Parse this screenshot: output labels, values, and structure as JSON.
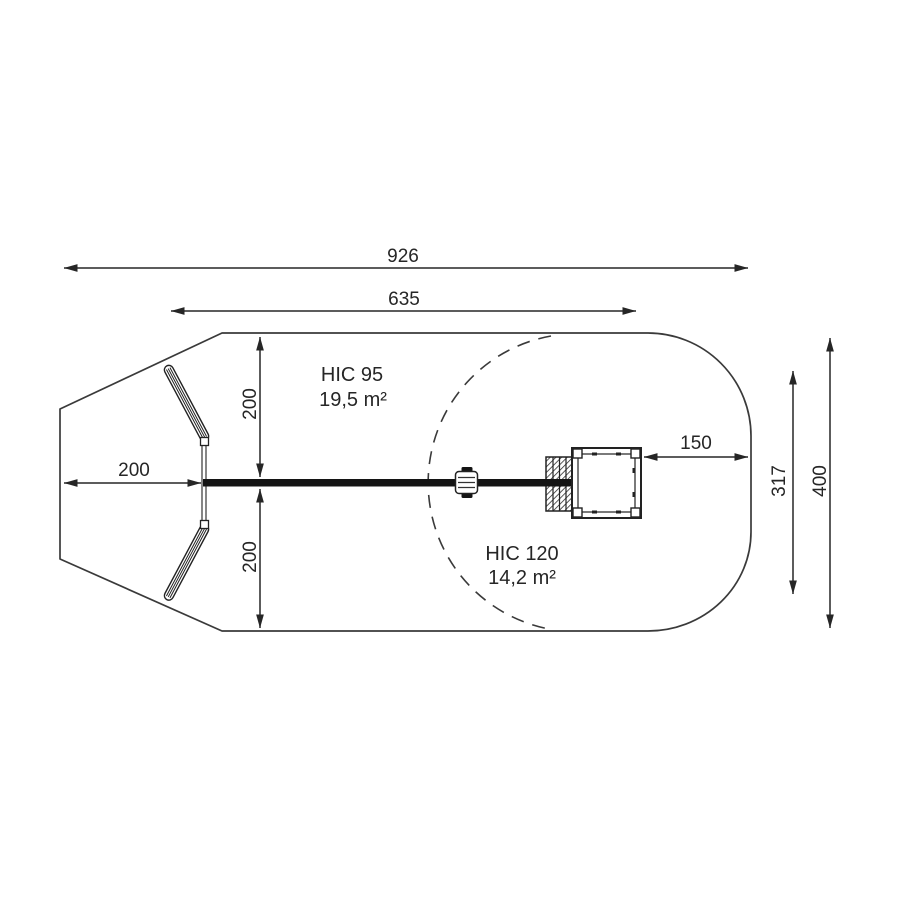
{
  "page": {
    "background": "#ffffff"
  },
  "colors": {
    "outline": "#3a3a3a",
    "dimension": "#262626",
    "text": "#262626",
    "beam": "#141414",
    "structure": "#222222"
  },
  "dims": {
    "total_width": "926",
    "swing_frame_width": "635",
    "left_clearance": "200",
    "upper_clearance": "200",
    "lower_clearance": "200",
    "right_clearance": "150",
    "hic120_zone_height": "317",
    "total_height": "400"
  },
  "zones": {
    "hic95": {
      "label": "HIC 95",
      "area": "19,5 m²"
    },
    "hic120": {
      "label": "HIC 120",
      "area": "14,2 m²"
    }
  }
}
